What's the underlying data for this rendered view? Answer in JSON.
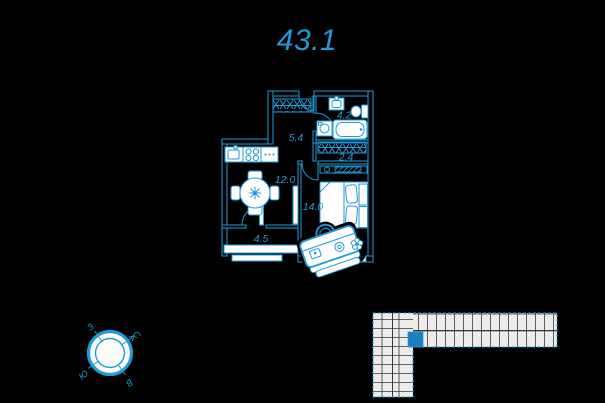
{
  "colors": {
    "background": "#000000",
    "accent": "#1f9bd9",
    "building_highlight": "#1c7fc2",
    "fixture_fill": "#ffffff",
    "building_fill": "#ececec"
  },
  "title": {
    "value": "43.1"
  },
  "plan": {
    "room_areas": {
      "hallway": "5.4",
      "bathroom": "4.2",
      "wardrobe": "2.4",
      "kitchen_living": "12.0",
      "bedroom": "14.0",
      "balcony": "4.5"
    }
  },
  "compass": {
    "north": "С",
    "east": "В",
    "south": "Ю",
    "west": "З"
  }
}
